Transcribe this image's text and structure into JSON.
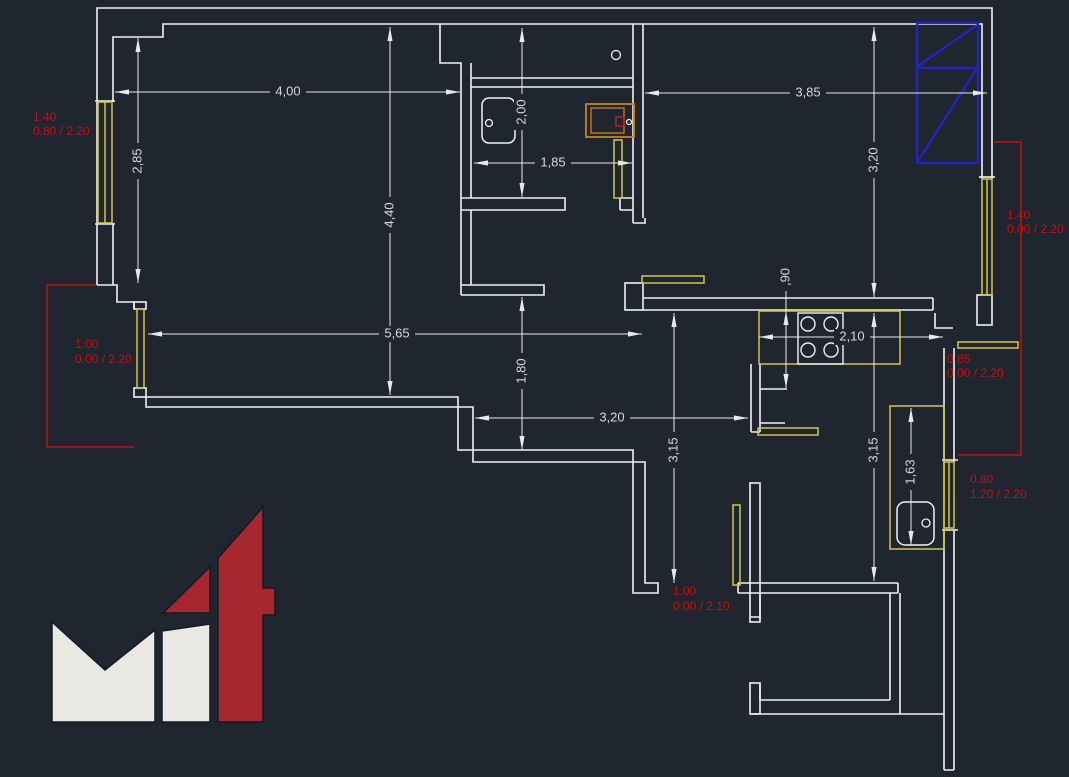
{
  "drawing": {
    "title": "apartment-floor-plan",
    "width_px": 1069,
    "height_px": 777
  },
  "colors": {
    "background": "#1f2630",
    "walls": "#f0f0f0",
    "dimension_text": "#d8d8d8",
    "joinery_yellow": "#d6c44c",
    "annotation_red": "#c11212",
    "appliance_orange": "#c9801f",
    "wardrobe_blue": "#2323cc",
    "logo_white": "#e9e8e3",
    "logo_red": "#a7272f"
  },
  "dimensions": {
    "room1_width": "4,00",
    "room1_height": "2,85",
    "room1_depth": "4,40",
    "bath_depth": "2,00",
    "bath_width": "1,85",
    "room2_width": "3,85",
    "room2_height": "3,20",
    "living_width": "5,65",
    "niche_height": "1,80",
    "kitchen_clearance": ",90",
    "kitchen_width": "2,10",
    "hall_width": "3,20",
    "hall_height_left": "3,15",
    "hall_height_right": "3,15",
    "counter_length": "1,63"
  },
  "opening_labels": {
    "bedroom1_window": {
      "line1": "1.40",
      "line2": "0.80 / 2.20"
    },
    "living_balcony_door": {
      "line1": "1.00",
      "line2": "0.00 / 2.20"
    },
    "bedroom2_window": {
      "line1": "1.40",
      "line2": "0.00 / 2.20"
    },
    "kitchen_opening": {
      "line1": "0.85",
      "line2": "0.00 / 2.20"
    },
    "kitchen_window": {
      "line1": "0.80",
      "line2": "1.20 / 2.20"
    },
    "hall_door": {
      "line1": "1.00",
      "line2": "0.00 / 2.10"
    }
  },
  "fixtures": [
    "bathroom-sink",
    "toilet",
    "water-heater",
    "cooktop-4-burner",
    "kitchen-sink",
    "wardrobe",
    "kitchen-counter",
    "wall-shelves"
  ]
}
